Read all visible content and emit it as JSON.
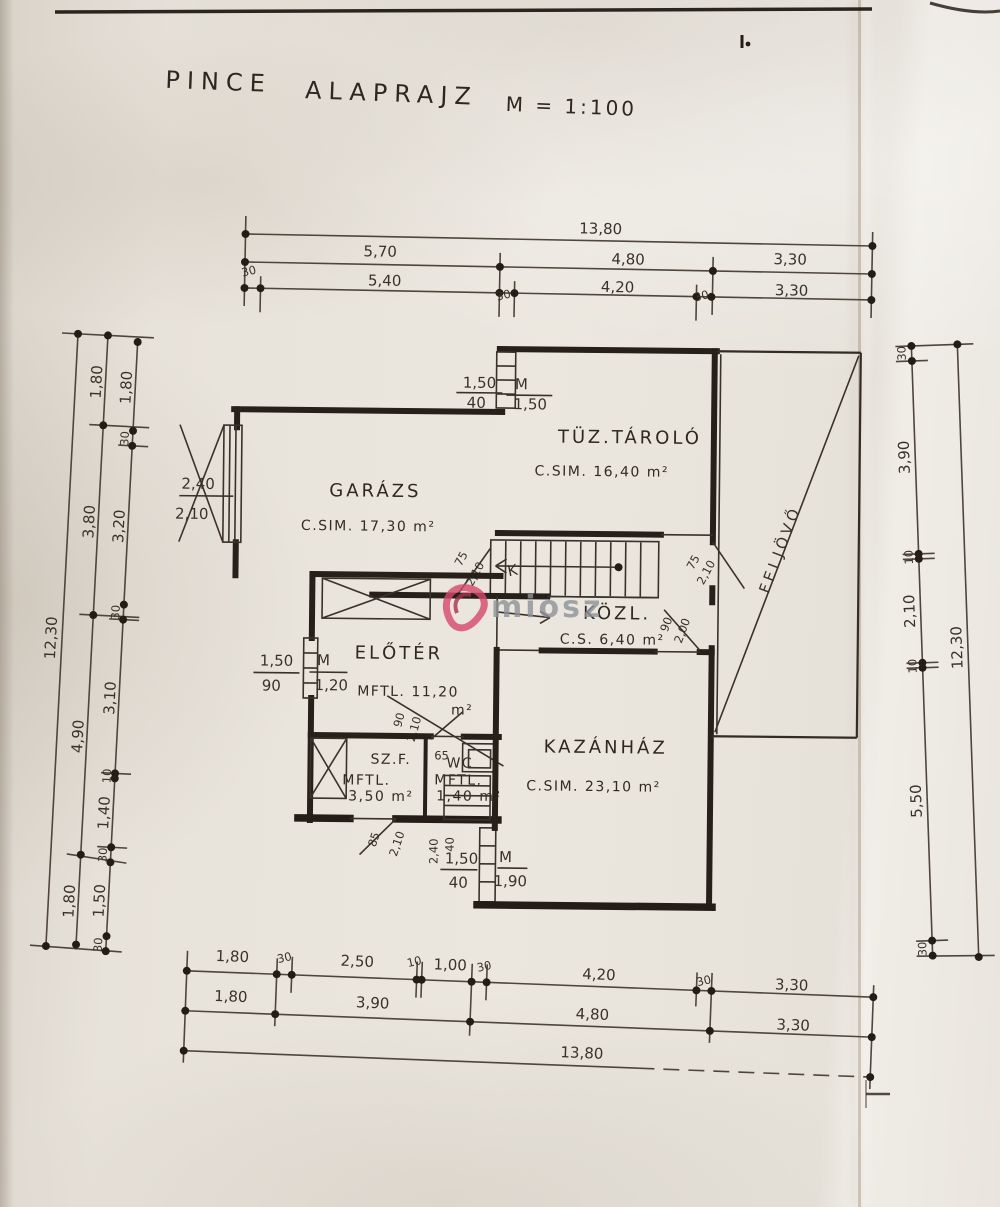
{
  "title": {
    "t1": "PINCE",
    "t2": "ALAPRAJZ",
    "t3": "M = 1:100"
  },
  "watermark": {
    "text": "miosz"
  },
  "rooms": {
    "garazs": {
      "name": "GARÁZS",
      "area": "C.SIM. 17,30 m²"
    },
    "tuztarolo": {
      "name": "TÜZ.TÁROLÓ",
      "area": "C.SIM. 16,40 m²"
    },
    "kozl": {
      "name": "KÖZL.",
      "area": "C.S. 6,40 m²"
    },
    "eloter": {
      "name": "ELŐTÉR",
      "area": "MFTL. 11,20",
      "unit": "m²"
    },
    "szf": {
      "name": "SZ.F.",
      "line1": "MFTL.",
      "line2": "3,50 m²"
    },
    "wc": {
      "name": "WC",
      "line1": "MFTL.",
      "line2": "1,40 m²"
    },
    "kazanhaz": {
      "name": "KAZÁNHÁZ",
      "area": "C.SIM. 23,10 m²"
    },
    "ramp": {
      "name": "FELJÖVŐ"
    }
  },
  "stair": {
    "mark": "K"
  },
  "openings": {
    "garage": {
      "w": "2,40",
      "h": "2,10"
    },
    "stairdoor": {
      "w": "75",
      "h": "2,10"
    },
    "upper": {
      "w": "75",
      "h": "2,10"
    },
    "kazan": {
      "w": "90",
      "h": "2,00"
    },
    "eloter": {
      "w": "90",
      "h": "2,10"
    },
    "wc": {
      "w": "65"
    },
    "lower": {
      "w": "85",
      "h": "2,10"
    },
    "niche": {
      "w": "2,40",
      "d": "40"
    }
  },
  "windows": {
    "north": {
      "w": "1,50",
      "sill": "40",
      "m": "M",
      "h": "1,50"
    },
    "west": {
      "w": "1,50",
      "sill": "90",
      "m": "M",
      "h": "1,20"
    },
    "south": {
      "w": "1,50",
      "sill": "40",
      "m": "M",
      "h": "1,90"
    }
  },
  "dims": {
    "top": {
      "total": "13,80",
      "row2": [
        "5,70",
        "4,80",
        "3,30"
      ],
      "row3": [
        "30",
        "5,40",
        "30",
        "4,20",
        "30",
        "3,30"
      ]
    },
    "bottom": {
      "row1": [
        "1,80",
        "30",
        "2,50",
        "10",
        "1,00",
        "30",
        "4,20",
        "30",
        "3,30"
      ],
      "row2": [
        "1,80",
        "3,90",
        "4,80",
        "3,30"
      ],
      "total": "13,80"
    },
    "left": {
      "total": "12,30",
      "mid": [
        "1,80",
        "3,80",
        "4,90",
        "1,80"
      ],
      "inner": [
        "1,80",
        "30",
        "3,20",
        "30",
        "3,10",
        "10",
        "1,40",
        "30",
        "1,50",
        "30"
      ]
    },
    "right": {
      "total": "12,30",
      "inner": [
        "30",
        "3,90",
        "10",
        "2,10",
        "10",
        "5,50",
        "30"
      ]
    }
  }
}
